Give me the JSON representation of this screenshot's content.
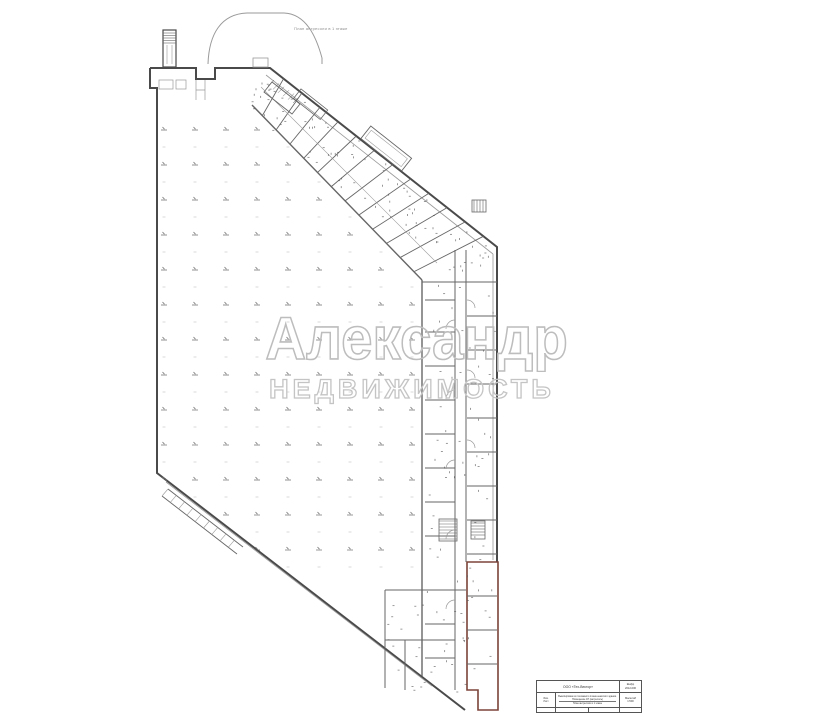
{
  "page": {
    "background": "#ffffff"
  },
  "plan": {
    "top_label": "План антресоли в 1 этаже",
    "watermark": {
      "line1": "Александр",
      "line2": "НЕДВИЖИМОСТЬ"
    }
  },
  "colors": {
    "wall_heavy": "#4a4a4a",
    "wall_medium": "#666666",
    "wall_light": "#9a9a9a",
    "marker": "#777777",
    "speckle": "#555555",
    "red_unit_outline": "#7b4338",
    "watermark_stroke": "#bdbdbd"
  },
  "title_block": {
    "company": "ООО «Тех-Вектор»",
    "code_line1": "Шифр",
    "code_line2": "2012-006",
    "left_line1": "Изм.",
    "left_line2": "Лист",
    "description": "Выкопировка из поэтажного плана нежилого здания. Помещение 1Н (антресоль)",
    "stage_line": "План антресоли в 1 этаже",
    "scale_label": "Масштаб",
    "scale_value": "1:500"
  }
}
